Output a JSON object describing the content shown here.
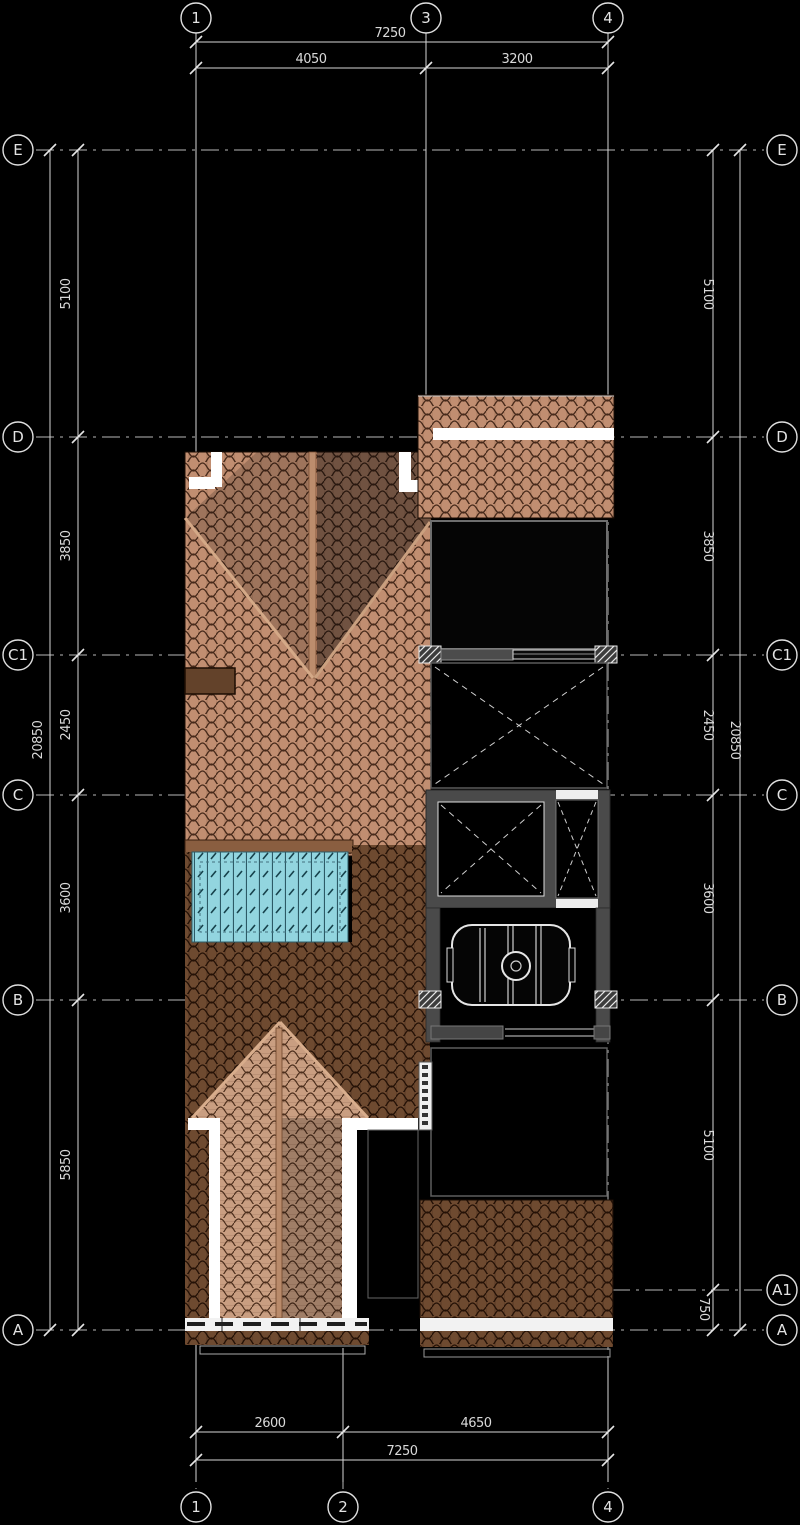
{
  "drawing": {
    "kind": "architectural roof plan",
    "background": "#000000",
    "colors": {
      "tile_light": "#c18e71",
      "tile_dark": "#6e4a30",
      "gable_tile": "#c99e81",
      "skylight_glass": "#92d5df",
      "wall_gray": "#4a4a4a",
      "line_white": "#e0e0e0"
    }
  },
  "axes": {
    "top": [
      "1",
      "3",
      "4"
    ],
    "bottom": [
      "1",
      "2",
      "4"
    ],
    "left": [
      "E",
      "D",
      "C1",
      "C",
      "B",
      "A"
    ],
    "right": [
      "E",
      "D",
      "C1",
      "C",
      "B",
      "A1",
      "A"
    ]
  },
  "dims": {
    "top": {
      "total": "7250",
      "segments": [
        "4050",
        "3200"
      ]
    },
    "bottom": {
      "total": "7250",
      "segments": [
        "2600",
        "4650"
      ]
    },
    "left": {
      "total": "20850",
      "segments": [
        "5100",
        "3850",
        "2450",
        "3600",
        "5850"
      ]
    },
    "right": {
      "total": "20850",
      "segments": [
        "5100",
        "3850",
        "2450",
        "3600",
        "5100",
        "750"
      ]
    }
  }
}
